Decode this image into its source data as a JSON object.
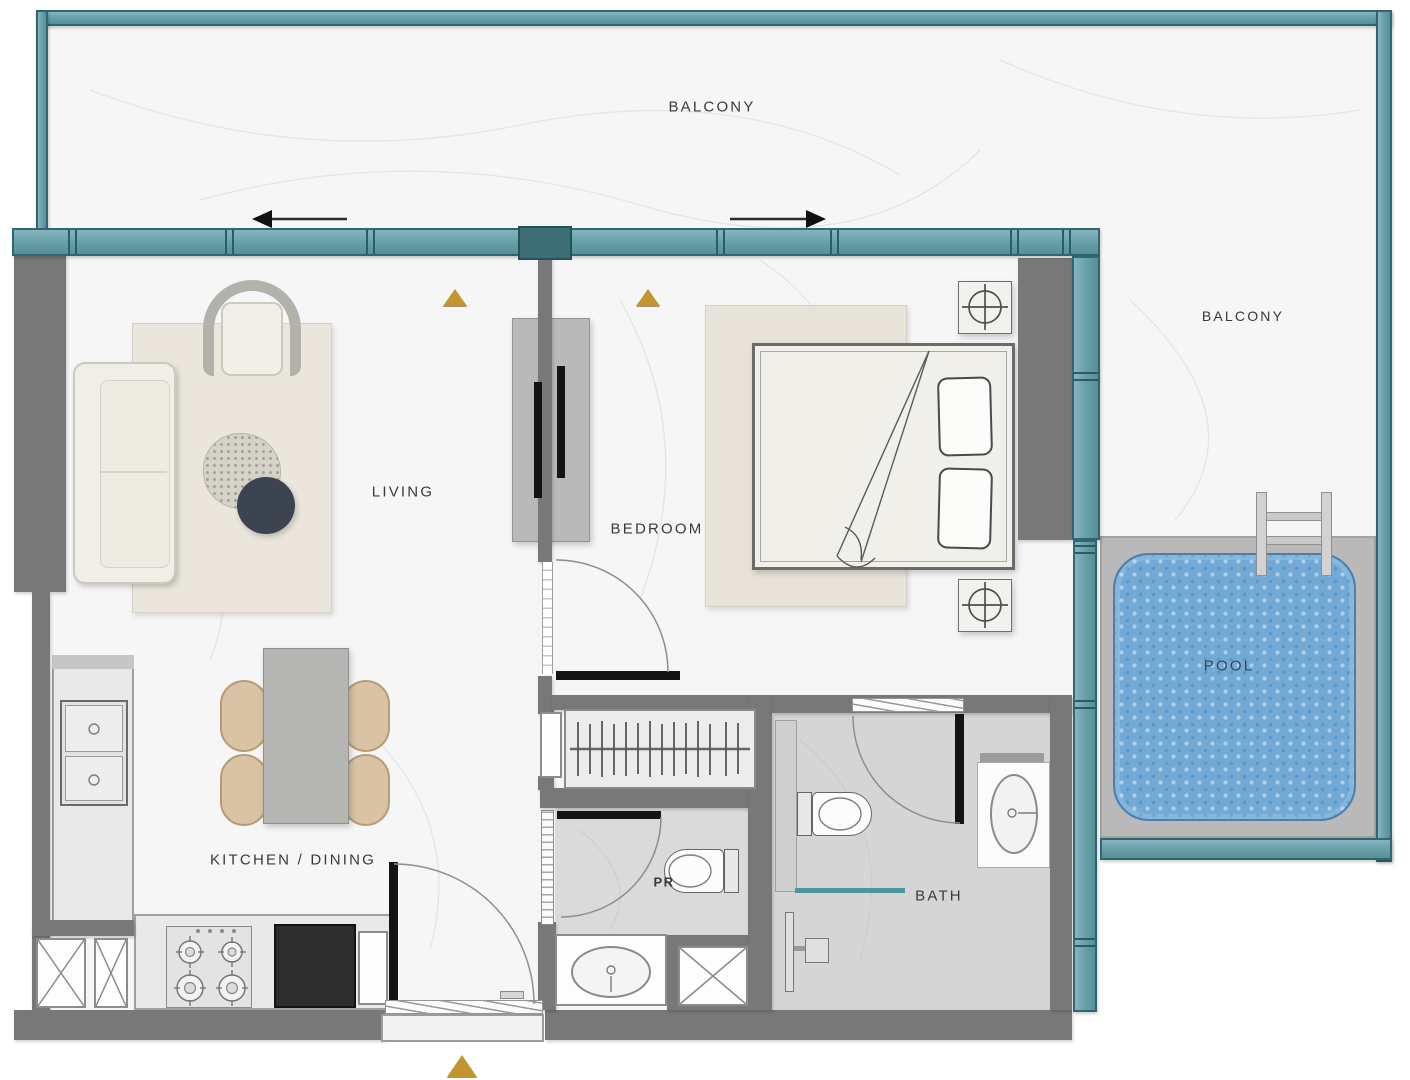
{
  "plan": {
    "type": "apartment-floor-plan",
    "rooms": {
      "balcony_top": {
        "label": "BALCONY"
      },
      "balcony_right": {
        "label": "BALCONY"
      },
      "living": {
        "label": "LIVING"
      },
      "bedroom": {
        "label": "BEDROOM"
      },
      "kitchen_dining": {
        "label": "KITCHEN / DINING"
      },
      "powder_room": {
        "label": "PR"
      },
      "bath": {
        "label": "BATH"
      },
      "pool": {
        "label": "POOL"
      }
    },
    "markers": {
      "direction_triangle_count": 3,
      "sliding_door_arrows": [
        "left",
        "right"
      ]
    }
  },
  "colors": {
    "teal": "#68a1aa",
    "teal_dark": "#2f6670",
    "teal_deep": "#3d6d75",
    "wall": "#787878",
    "floor": "#f6f6f7",
    "bath_floor": "#d5d5d5",
    "counter": "#e9e9e9",
    "counter_black": "#2d2d2d",
    "pool_water": "#72aad6",
    "pool_deck": "#b9b9b9",
    "gold": "#c2952f",
    "rug": "#eae6dc",
    "cream": "#f0eee6",
    "chair_tan": "#d9c3a4",
    "navy": "#3c4450",
    "shower_teal": "#4a96a0",
    "label": "#3a3a3a"
  }
}
